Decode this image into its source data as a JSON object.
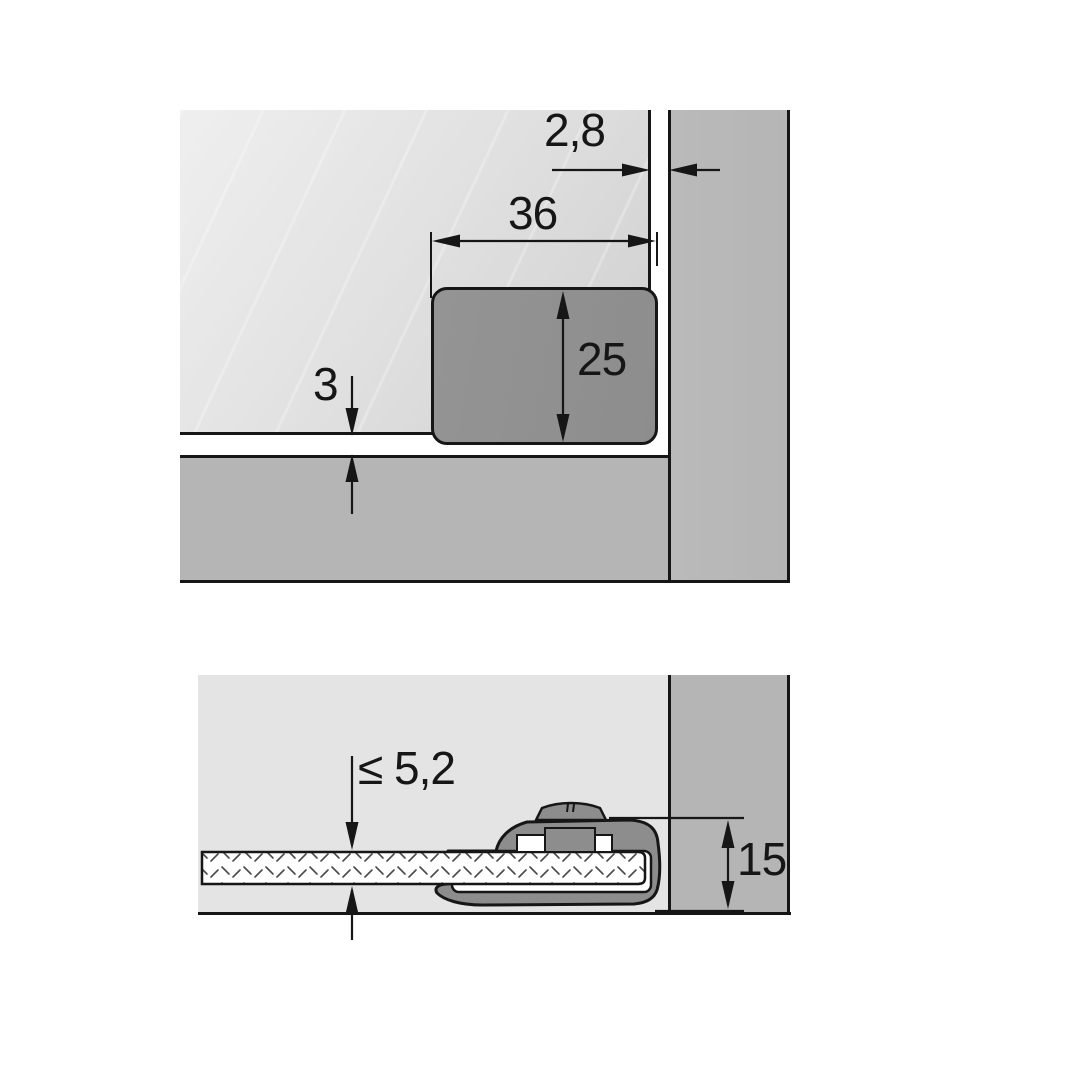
{
  "colors": {
    "line": "#161616",
    "door_light": "#efefef",
    "door_dark": "#cfcfcf",
    "board_gray": "#b5b5b5",
    "fitting_gray": "#8d8d8d",
    "section_bg": "#e4e4e4",
    "glass_white": "#ffffff",
    "hatch_stroke": "#4a4a4a"
  },
  "top_view": {
    "dimensions": {
      "door_side_gap": "2,8",
      "catch_width": "36",
      "catch_height": "25",
      "door_bottom_gap": "3"
    }
  },
  "bottom_view": {
    "dimensions": {
      "glass_thickness_max": "≤ 5,2",
      "fitting_height": "15"
    }
  }
}
